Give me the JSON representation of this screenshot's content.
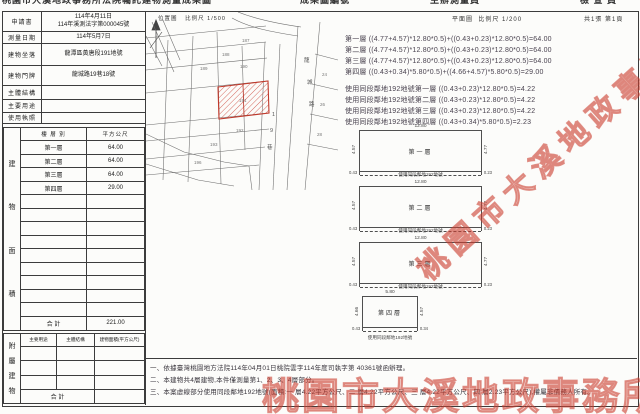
{
  "clipped_header": {
    "title": "桃園市大溪地政事務所法院囑託建物測量成果圖",
    "seg2": "成果圖編號",
    "seg3": "主辦測量員",
    "seg4": "檢 查 員"
  },
  "info": {
    "rows": [
      {
        "label": "申請書",
        "value1": "114年4月11日",
        "value2": "114年溪測法字第000045號"
      },
      {
        "label": "測量日期",
        "value": "114年5月7日"
      },
      {
        "label": "建物坐落",
        "value": "龍潭區黃唐段191地號"
      },
      {
        "label": "建物門牌",
        "value": "龍城路19巷18號"
      },
      {
        "label": "主體結構",
        "value": ""
      },
      {
        "label": "主要用途",
        "value": ""
      },
      {
        "label": "使用執照",
        "value": ""
      }
    ]
  },
  "floor": {
    "side": [
      "建",
      "物",
      "面",
      "積"
    ],
    "header": {
      "col1": "樓 層 別",
      "col2": "平方公尺"
    },
    "rows": [
      {
        "label": "第一層",
        "area": "64.00"
      },
      {
        "label": "第二層",
        "area": "64.00"
      },
      {
        "label": "第三層",
        "area": "64.00"
      },
      {
        "label": "第四層",
        "area": "29.00"
      }
    ],
    "total_label": "合  計",
    "total_area": "221.00"
  },
  "annex": {
    "side": [
      "附",
      "屬",
      "建",
      "物"
    ],
    "headers": [
      "主要用途",
      "主體結構",
      "建物面積(平方公尺)"
    ],
    "total_label": "合  計"
  },
  "map": {
    "title": "位置圖",
    "scale": "比例尺 1/500",
    "road": [
      "龍",
      "城",
      "路"
    ],
    "lane": [
      "1",
      "9",
      "巷"
    ],
    "parcels": [
      "187",
      "188",
      "189",
      "190",
      "191",
      "192",
      "193",
      "196",
      "24",
      "26",
      "28"
    ]
  },
  "plan_header": {
    "label": "平面圖",
    "scale": "比例尺 1/200",
    "sheet": "共1張 第1頁"
  },
  "calculations": {
    "group1": [
      "第一層 ((4.77+4.57)*12.80*0.5)+((0.43+0.23)*12.80*0.5)=64.00",
      "第二層 ((4.77+4.57)*12.80*0.5)+((0.43+0.23)*12.80*0.5)=64.00",
      "第三層 ((4.77+4.57)*12.80*0.5)+((0.43+0.23)*12.80*0.5)=64.00",
      "第四層 ((0.43+0.34)*5.80*0.5)+((4.66+4.57)*5.80*0.5)=29.00"
    ],
    "group2": [
      "使用同段鄰地192地號第一層 ((0.43+0.23)*12.80*0.5)=4.22",
      "使用同段鄰地192地號第二層 ((0.43+0.23)*12.80*0.5)=4.22",
      "使用同段鄰地192地號第三層 ((0.43+0.23)*12.80*0.5)=4.22",
      "使用同段鄰地192地號第四層 ((0.43+0.34)*5.80*0.5)=2.23"
    ]
  },
  "plans": [
    {
      "name": "第一層",
      "top": "12.80",
      "left": "4.57",
      "right": "4.77",
      "strip_left": "0.43",
      "strip_right": "0.23",
      "strip_label": "使用同段鄰地192地號"
    },
    {
      "name": "第二層",
      "top": "12.80",
      "left": "4.57",
      "right": "4.77",
      "strip_left": "0.43",
      "strip_right": "0.23",
      "strip_label": "使用同段鄰地192地號"
    },
    {
      "name": "第三層",
      "top": "12.80",
      "left": "4.57",
      "right": "4.77",
      "strip_left": "0.43",
      "strip_right": "0.23",
      "strip_label": "使用同段鄰地192地號"
    },
    {
      "name": "第四層",
      "top": "5.80",
      "left": "4.66",
      "right": "4.57",
      "strip_left": "0.43",
      "strip_right": "0.34",
      "strip_label": "使用同段鄰地192地號"
    }
  ],
  "notes": [
    "一、依據臺灣桃園地方法院114年04月01日桃院雲字114年度司執字第 40361號函辦理。",
    "二、本建物共4層建物,本件僅測量第1、2、3、4層部分。",
    "三、本案虛線部分使用同段鄰地192地號(面積:一 層4.22平方公尺、二 層4.22平方公尺、三 層4.22平方公尺、四 層2.23平方公尺),權屬非債務人所有。"
  ],
  "watermark": {
    "text": "桃園市大溪地政事務所"
  }
}
